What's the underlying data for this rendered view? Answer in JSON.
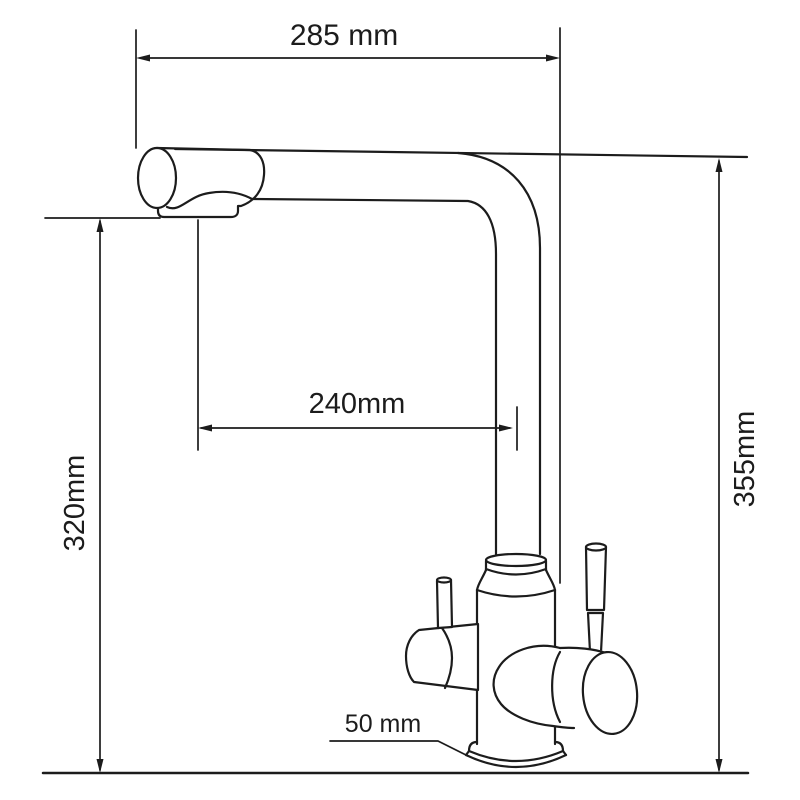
{
  "drawing": {
    "background_color": "#ffffff",
    "line_color": "#1c1c1c",
    "dimensions": {
      "top_width": "285 mm",
      "spout_reach": "240mm",
      "spout_height": "320mm",
      "total_height": "355mm",
      "base_width": "50 mm"
    }
  }
}
